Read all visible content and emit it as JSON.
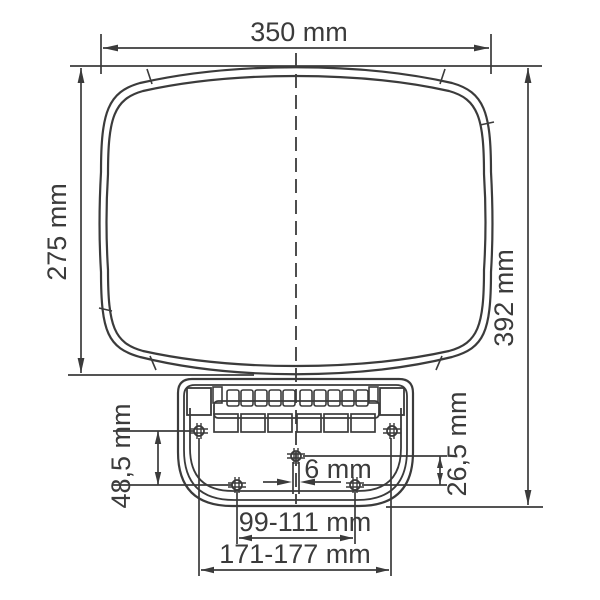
{
  "diagram": {
    "type": "technical-drawing",
    "subject": "Mirror head with mounting bracket, front view with mounting dimensions",
    "unit": "mm",
    "colors": {
      "background": "#ffffff",
      "line": "#3b3b3b",
      "text": "#3b3b3b"
    },
    "labels": {
      "overall_width": "350 mm",
      "glass_height": "275 mm",
      "overall_height": "392 mm",
      "upper_to_lower_holes": "48,5 mm",
      "center_hole_offset": "6 mm",
      "center_to_lower_holes": "26,5 mm",
      "lower_holes_spacing": "99-111 mm",
      "upper_holes_spacing": "171-177 mm"
    }
  }
}
